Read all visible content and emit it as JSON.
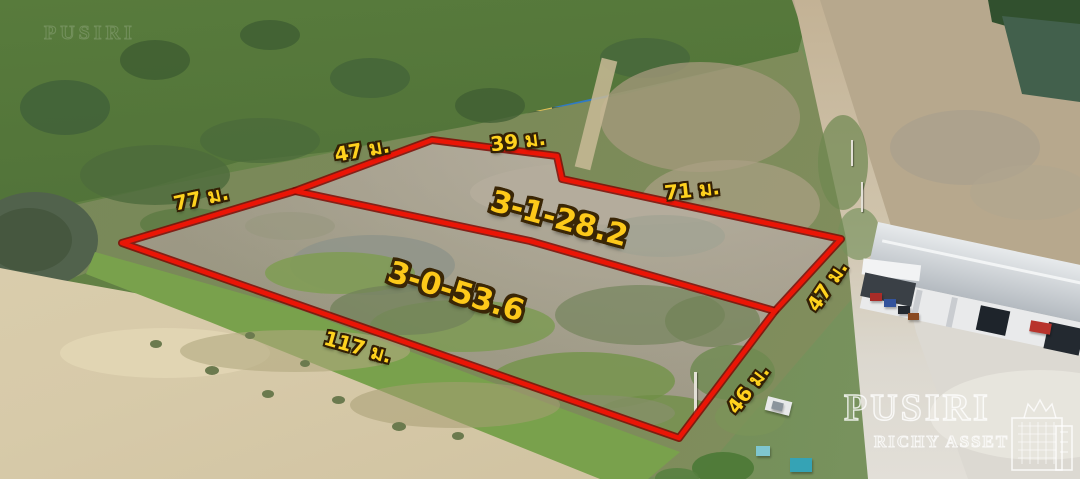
{
  "annotation_overlay": {
    "plots": [
      {
        "position": "upper",
        "area_label": "3-1-28.2"
      },
      {
        "position": "lower",
        "area_label": "3-0-53.6"
      }
    ],
    "dimension_labels": [
      {
        "side": "left",
        "text": "77 ม."
      },
      {
        "side": "top-left",
        "text": "47 ม."
      },
      {
        "side": "top",
        "text": "39 ม."
      },
      {
        "side": "top-right",
        "text": "71 ม."
      },
      {
        "side": "right-upper",
        "text": "47 ม."
      },
      {
        "side": "right-lower",
        "text": "46 ม."
      },
      {
        "side": "bottom",
        "text": "117 ม."
      }
    ],
    "boundary_color": "#ea1506",
    "label_color": "#ffd21e",
    "label_outline_color": "#332005"
  },
  "watermark": {
    "title": "PUSIRI",
    "subtitle": "RICHY ASSET",
    "color": "#ffffff"
  }
}
